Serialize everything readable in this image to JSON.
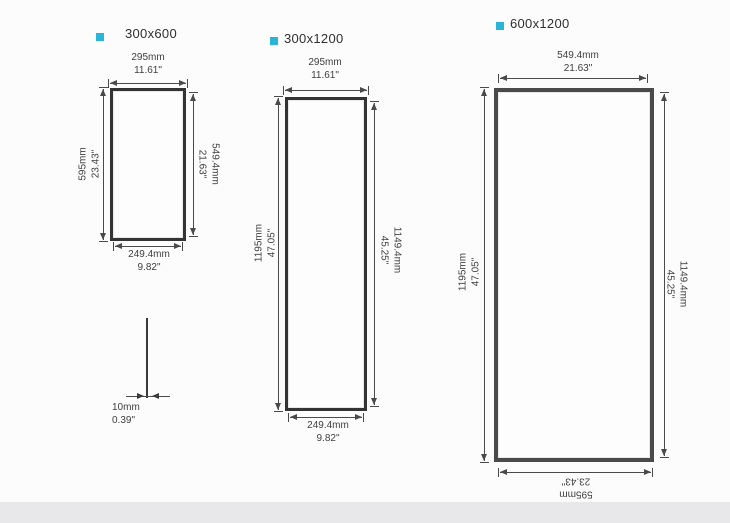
{
  "colors": {
    "accent": "#2ab4d6",
    "dimension_line": "#4a4a4a",
    "frame": "#343434",
    "background": "#fcfcfc",
    "footer_band": "#e8e8ea"
  },
  "panels": [
    {
      "label": "300x600",
      "top": {
        "mm": "295mm",
        "in": "11.61\""
      },
      "left": {
        "mm": "595mm",
        "in": "23.43\""
      },
      "right": {
        "mm": "549.4mm",
        "in": "21.63\""
      },
      "bottom": {
        "mm": "249.4mm",
        "in": "9.82\""
      }
    },
    {
      "label": "300x1200",
      "top": {
        "mm": "295mm",
        "in": "11.61\""
      },
      "left": {
        "mm": "1195mm",
        "in": "47.05\""
      },
      "right": {
        "mm": "1149.4mm",
        "in": "45.25\""
      },
      "bottom": {
        "mm": "249.4mm",
        "in": "9.82\""
      }
    },
    {
      "label": "600x1200",
      "top": {
        "mm": "549.4mm",
        "in": "21.63\""
      },
      "left": {
        "mm": "1195mm",
        "in": "47.05\""
      },
      "right": {
        "mm": "1149.4mm",
        "in": "45.25\""
      },
      "bottom": {
        "mm": "595mm",
        "in": "23.43\""
      }
    }
  ],
  "side_profile": {
    "mm": "10mm",
    "in": "0.39\""
  }
}
